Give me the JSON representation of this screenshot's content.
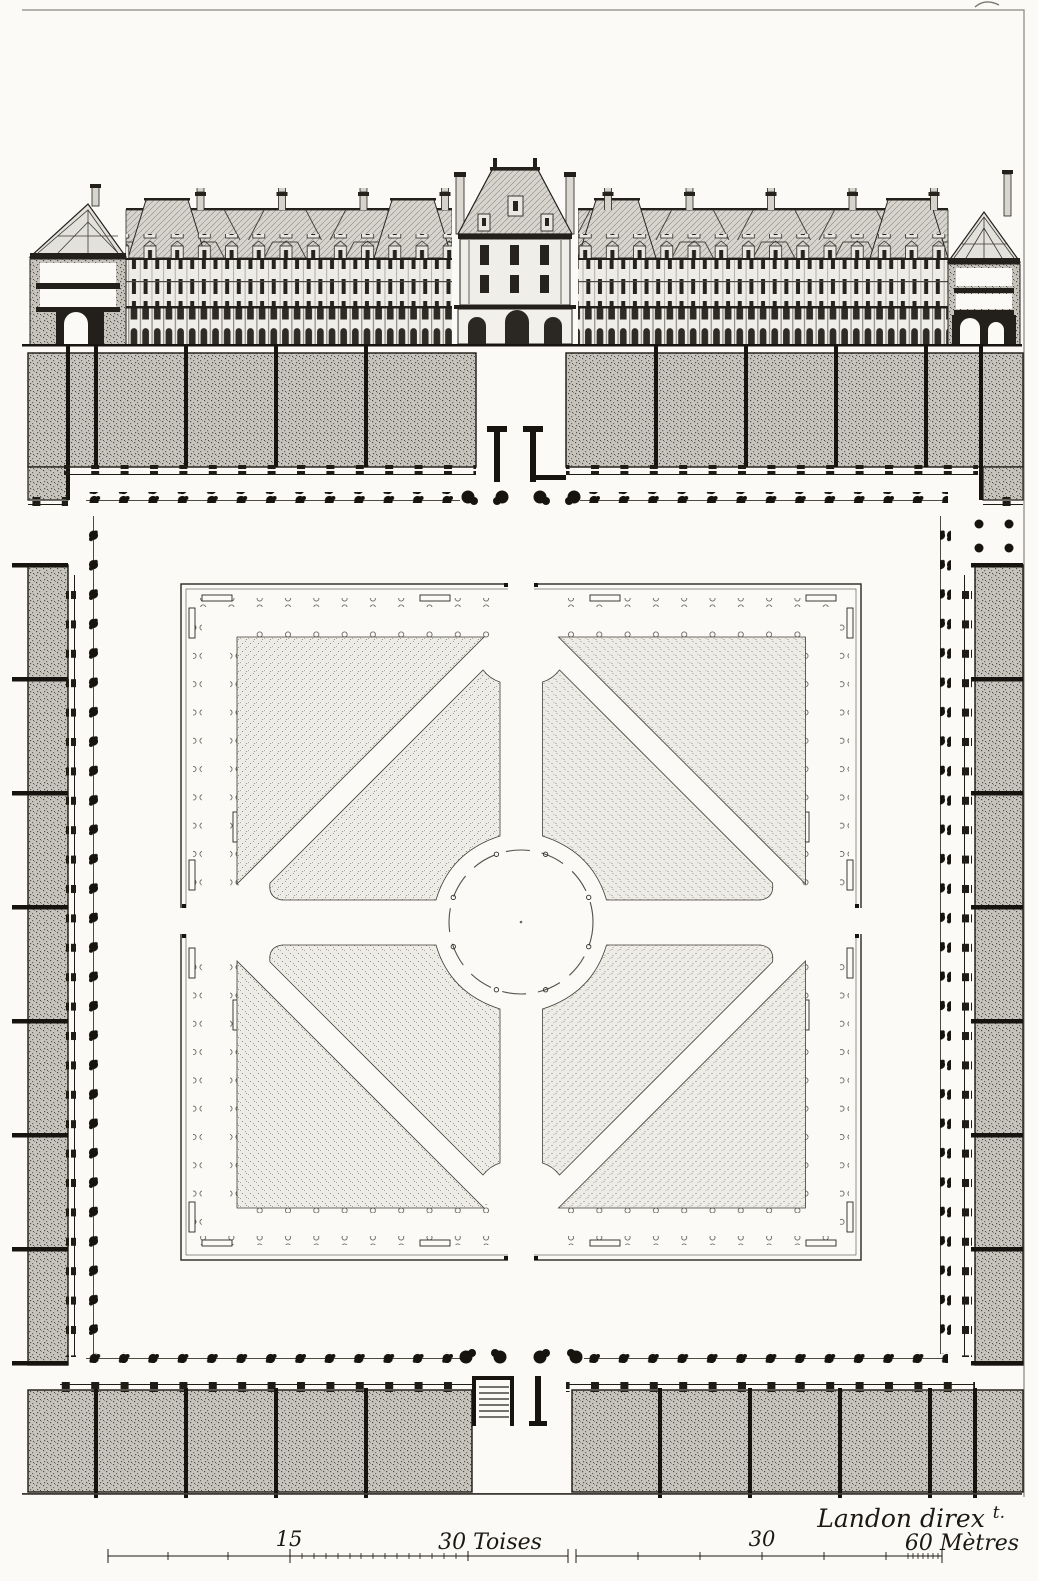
{
  "plate": {
    "signature": {
      "text": "Landon direx",
      "superscript": "t."
    },
    "scale_bar_toises": {
      "mid_label": "15",
      "end_label": "30 Toises"
    },
    "scale_bar_metres": {
      "mid_label": "30",
      "end_label": "60 Mètres"
    },
    "colors": {
      "paper": "#fbfaf7",
      "ink": "#1c1813",
      "building_stipple_base": "#c7c4be",
      "parterre_stipple_base": "#eeece6",
      "roof_tone": "#d7d4ce"
    }
  }
}
